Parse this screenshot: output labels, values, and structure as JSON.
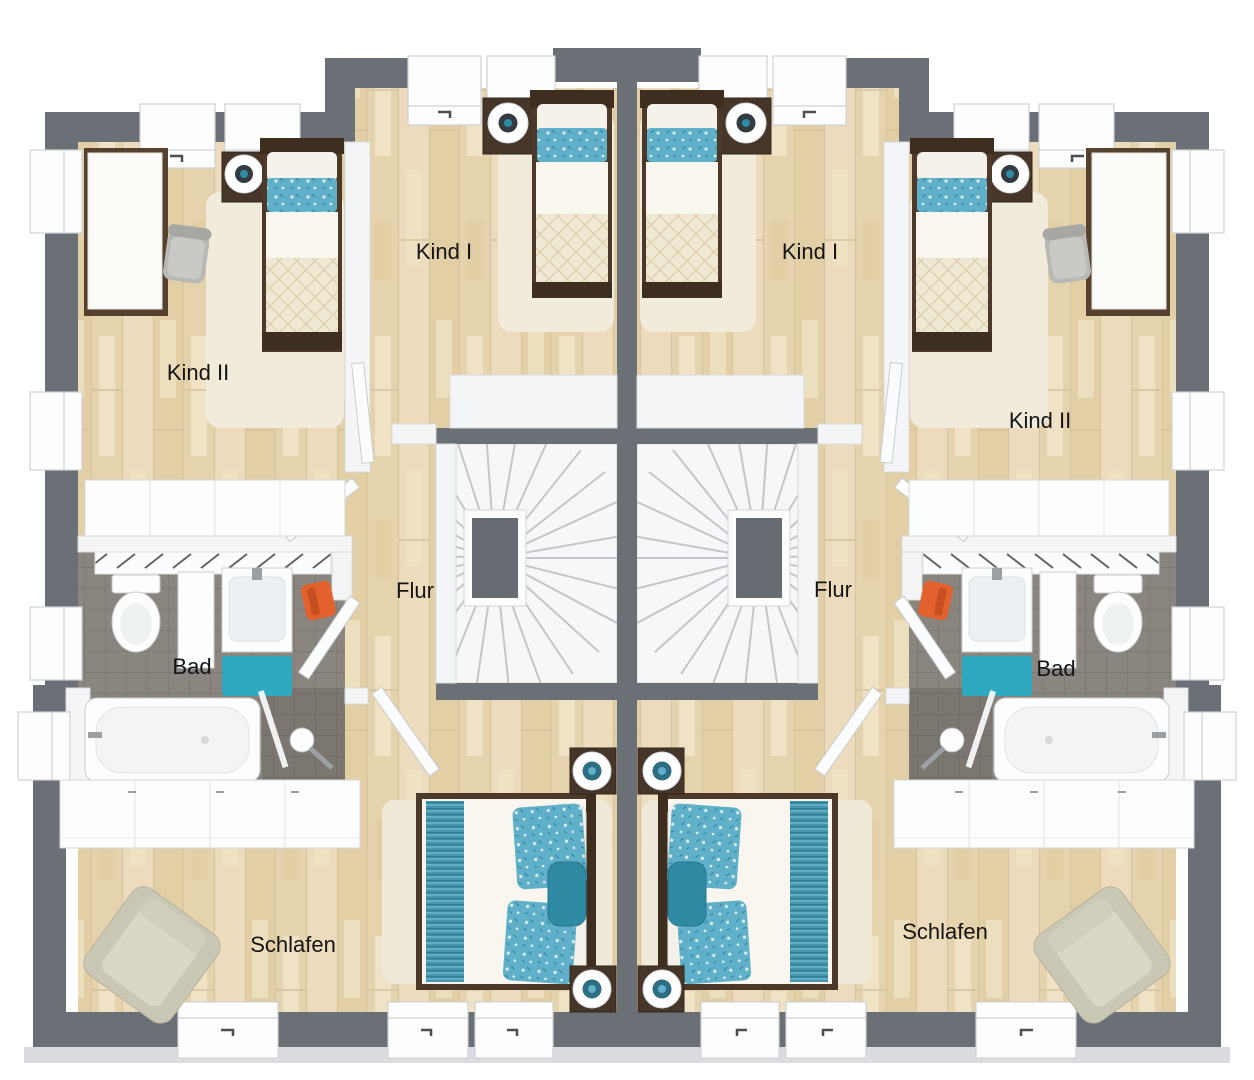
{
  "plan": {
    "type": "3d-floor-plan-upper-storey-duplex",
    "rooms": {
      "left": {
        "kind1": "Kind I",
        "kind2": "Kind II",
        "flur": "Flur",
        "bad": "Bad",
        "schlafen": "Schlafen"
      },
      "right": {
        "kind1": "Kind I",
        "kind2": "Kind II",
        "flur": "Flur",
        "bad": "Bad",
        "schlafen": "Schlafen"
      }
    }
  },
  "palette": {
    "wall_gray": "#6a7076",
    "wall_core": "#666c72",
    "floor_wood": "#e8d8b6",
    "wood_plank_dark": "#e1cfa7",
    "wood_plank_light": "#f1e5c8",
    "tile_gray": "#8a857e",
    "tile_grout": "#7a756e",
    "shower_tile": "#7d7871",
    "white_fixture": "#fdfdfd",
    "fixture_outline": "#d3d6d9",
    "dark_wood": "#4c3929",
    "teal_bedding": "#4795ad",
    "teal_pillow": "#5fb0c8",
    "teal_accent": "#2f8aa4",
    "teal_mat": "#2fa9c0",
    "cream_quilt": "#efe8d0",
    "rug": "#f1ebdc",
    "armchair": "#cbc7b5",
    "towel_orange": "#e2612c",
    "ground_shadow": "#dbdce0",
    "label_text": "#141414"
  }
}
